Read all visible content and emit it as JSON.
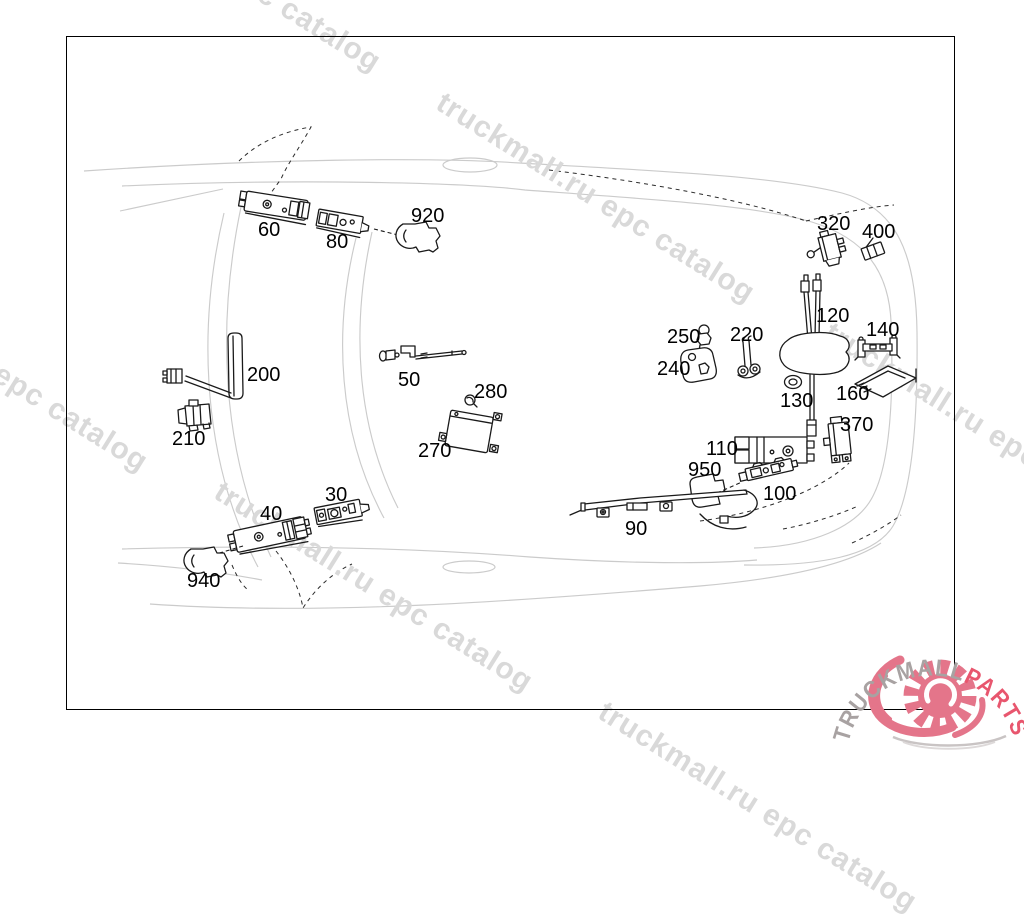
{
  "watermark": {
    "text": "truckmall.ru epc catalog",
    "color": "#d9d9d9",
    "rotation_deg": 32,
    "instances": [
      {
        "x": 74,
        "y": -145
      },
      {
        "x": 448,
        "y": 86
      },
      {
        "x": -159,
        "y": 255
      },
      {
        "x": 836,
        "y": 316
      },
      {
        "x": 226,
        "y": 475
      },
      {
        "x": 610,
        "y": 695
      }
    ]
  },
  "part_labels": [
    {
      "id": "60",
      "x": 258,
      "y": 220
    },
    {
      "id": "80",
      "x": 326,
      "y": 232
    },
    {
      "id": "920",
      "x": 411,
      "y": 206
    },
    {
      "id": "320",
      "x": 817,
      "y": 214
    },
    {
      "id": "400",
      "x": 862,
      "y": 222
    },
    {
      "id": "120",
      "x": 816,
      "y": 306
    },
    {
      "id": "140",
      "x": 866,
      "y": 320
    },
    {
      "id": "250",
      "x": 667,
      "y": 327
    },
    {
      "id": "220",
      "x": 730,
      "y": 325
    },
    {
      "id": "240",
      "x": 657,
      "y": 359
    },
    {
      "id": "130",
      "x": 780,
      "y": 391
    },
    {
      "id": "160",
      "x": 836,
      "y": 384
    },
    {
      "id": "370",
      "x": 840,
      "y": 415
    },
    {
      "id": "110",
      "x": 706,
      "y": 439
    },
    {
      "id": "950",
      "x": 688,
      "y": 460
    },
    {
      "id": "100",
      "x": 763,
      "y": 484
    },
    {
      "id": "90",
      "x": 625,
      "y": 519
    },
    {
      "id": "200",
      "x": 247,
      "y": 365
    },
    {
      "id": "210",
      "x": 172,
      "y": 429
    },
    {
      "id": "50",
      "x": 398,
      "y": 370
    },
    {
      "id": "280",
      "x": 474,
      "y": 382
    },
    {
      "id": "270",
      "x": 418,
      "y": 441
    },
    {
      "id": "40",
      "x": 260,
      "y": 504
    },
    {
      "id": "30",
      "x": 325,
      "y": 485
    },
    {
      "id": "940",
      "x": 187,
      "y": 571
    }
  ],
  "logo": {
    "brand_primary": "TRUCKMALL",
    "brand_accent": "PARTS",
    "primary_color": "#a8a2a2",
    "accent_color": "#e8566e",
    "gear_color": "#e4758a"
  },
  "colors": {
    "background": "#ffffff",
    "frame": "#000000",
    "car_outline": "#cbcbcb",
    "part_ink": "#1a1a1a"
  }
}
